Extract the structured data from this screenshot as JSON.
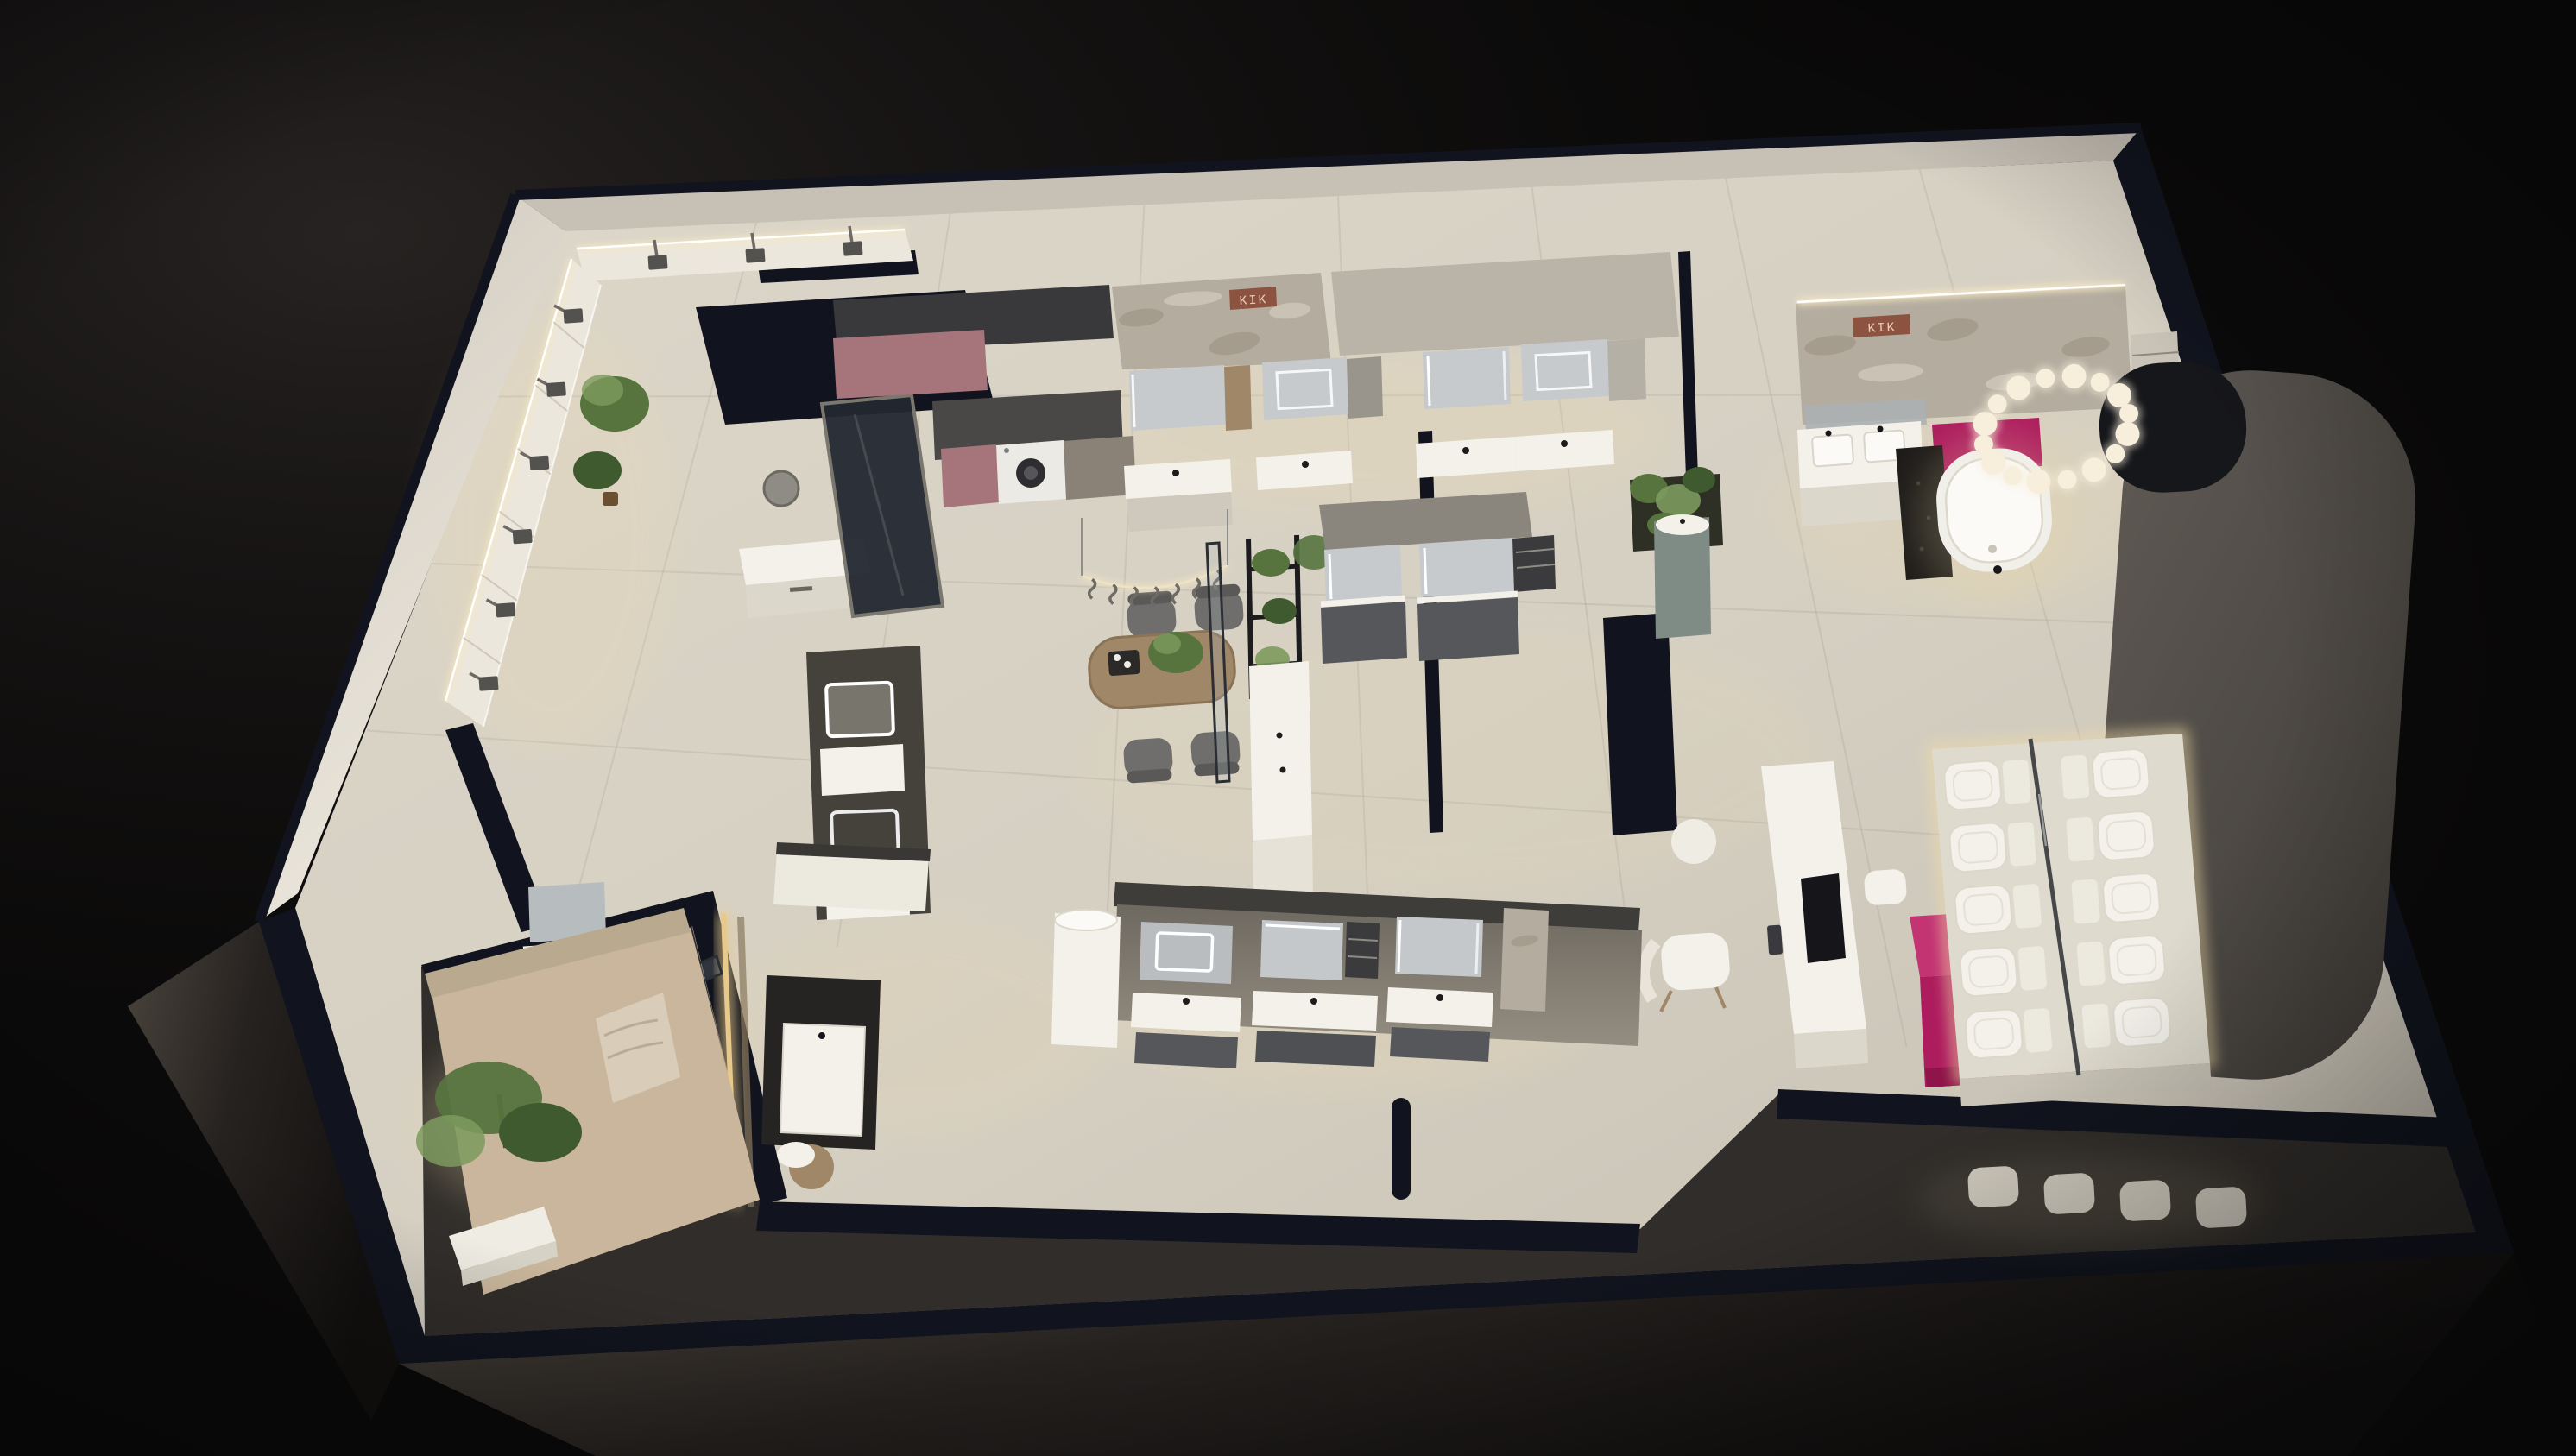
{
  "meta": {
    "title": "Bathroom showroom - night isometric cutaway render",
    "view": "bird's-eye 3D floor plan"
  },
  "signs": {
    "stone_column_logo": "KIK",
    "feature_wall_logo": "KIK"
  },
  "fixtures": {
    "shower_wall": {
      "top_heads": 3,
      "left_heads": 6
    },
    "pendant_rail_hooks": 7,
    "ring_chandelier_bulbs": 16,
    "toilet_display": {
      "rows": 5,
      "columns": 2
    },
    "exterior_toilet_row": 4,
    "dining_chairs": 4,
    "top_vanity_units": 4,
    "bottom_vanity_units": 3,
    "washing_machines": 1,
    "bathtubs": 1
  },
  "zones": [
    {
      "id": "shower-display-wall",
      "label": "shower panel display wall"
    },
    {
      "id": "entry-reception",
      "label": "entry desk"
    },
    {
      "id": "laundry-display",
      "label": "laundry appliance display"
    },
    {
      "id": "stone-logo-column",
      "label": "stone column with logo"
    },
    {
      "id": "top-vanity-row",
      "label": "wall-hung vanity displays"
    },
    {
      "id": "dining-set",
      "label": "consultation table"
    },
    {
      "id": "bath-suite",
      "label": "bathtub suite with ring chandelier"
    },
    {
      "id": "magenta-reception",
      "label": "magenta reception counter"
    },
    {
      "id": "toilet-display",
      "label": "toilet display platform"
    },
    {
      "id": "media-counter",
      "label": "media counter"
    },
    {
      "id": "bottom-vanity-row",
      "label": "south vanity aisle"
    },
    {
      "id": "lounge-corner",
      "label": "planted lounge corner"
    }
  ],
  "palette": {
    "background": "#0b0a0a",
    "bg_glow": "#2a2625",
    "wall_cap": "#11141e",
    "wall_face_light": "#cfc9be",
    "wall_face_bright": "#ece7dc",
    "wall_top_band": "#c6c0b5",
    "floor_light": "#ddd7ca",
    "floor_shade": "#c5bfb2",
    "floor_seam": "#8e887c",
    "dark_zone": "#262321",
    "plinth_light": "#4a443c",
    "plinth_dark": "#12100f",
    "stone": "#b4ac9f",
    "stone_vein_dark": "#9c9384",
    "stone_vein_light": "#d7d1c5",
    "copper": "#8c5440",
    "copper_text": "#eccdb9",
    "led_warm": "#f6e8c3",
    "led_cool": "#ffffff",
    "glow_warm": "#f0dca6",
    "accent_magenta": "#ad1d5e",
    "accent_magenta_deep": "#8f1449",
    "accent_magenta_top": "#c23472",
    "mauve": "#a6747b",
    "mauve_dark": "#39383a",
    "taupe_cabinet": "#8a8277",
    "appliance_white": "#eceae4",
    "appliance_door": "#2e2e31",
    "counter_white": "#f3f1ea",
    "counter_face": "#dcd7cb",
    "cabinet_gray": "#55575a",
    "cabinet_graphite": "#3b3b3e",
    "mirror_glass": "#c6cacd",
    "wood": "#a08767",
    "wood_dark": "#6b4f33",
    "fabric_gray": "#6f6e6c",
    "fabric_dark": "#5a5957",
    "plant_green": "#57743f",
    "plant_green_dark": "#3f5a2e",
    "plant_green_light": "#7d9a5e",
    "teal_cabinet": "#7e8c85",
    "glass_tint": "#aab3b8",
    "glass_frame": "#2b2e33",
    "dark_counter": "#262422",
    "tub_white": "#f1efe9",
    "curved_wall": "#5f5a54",
    "curved_wall_dark": "#403c38",
    "arch_dark": "#16171b",
    "gold_led": "#e7c98c",
    "shower_head": "#54524e",
    "lounge_floor": "#c9b69c",
    "lounge_wall": "#b9a98f",
    "bulb": "#f7eedb"
  }
}
